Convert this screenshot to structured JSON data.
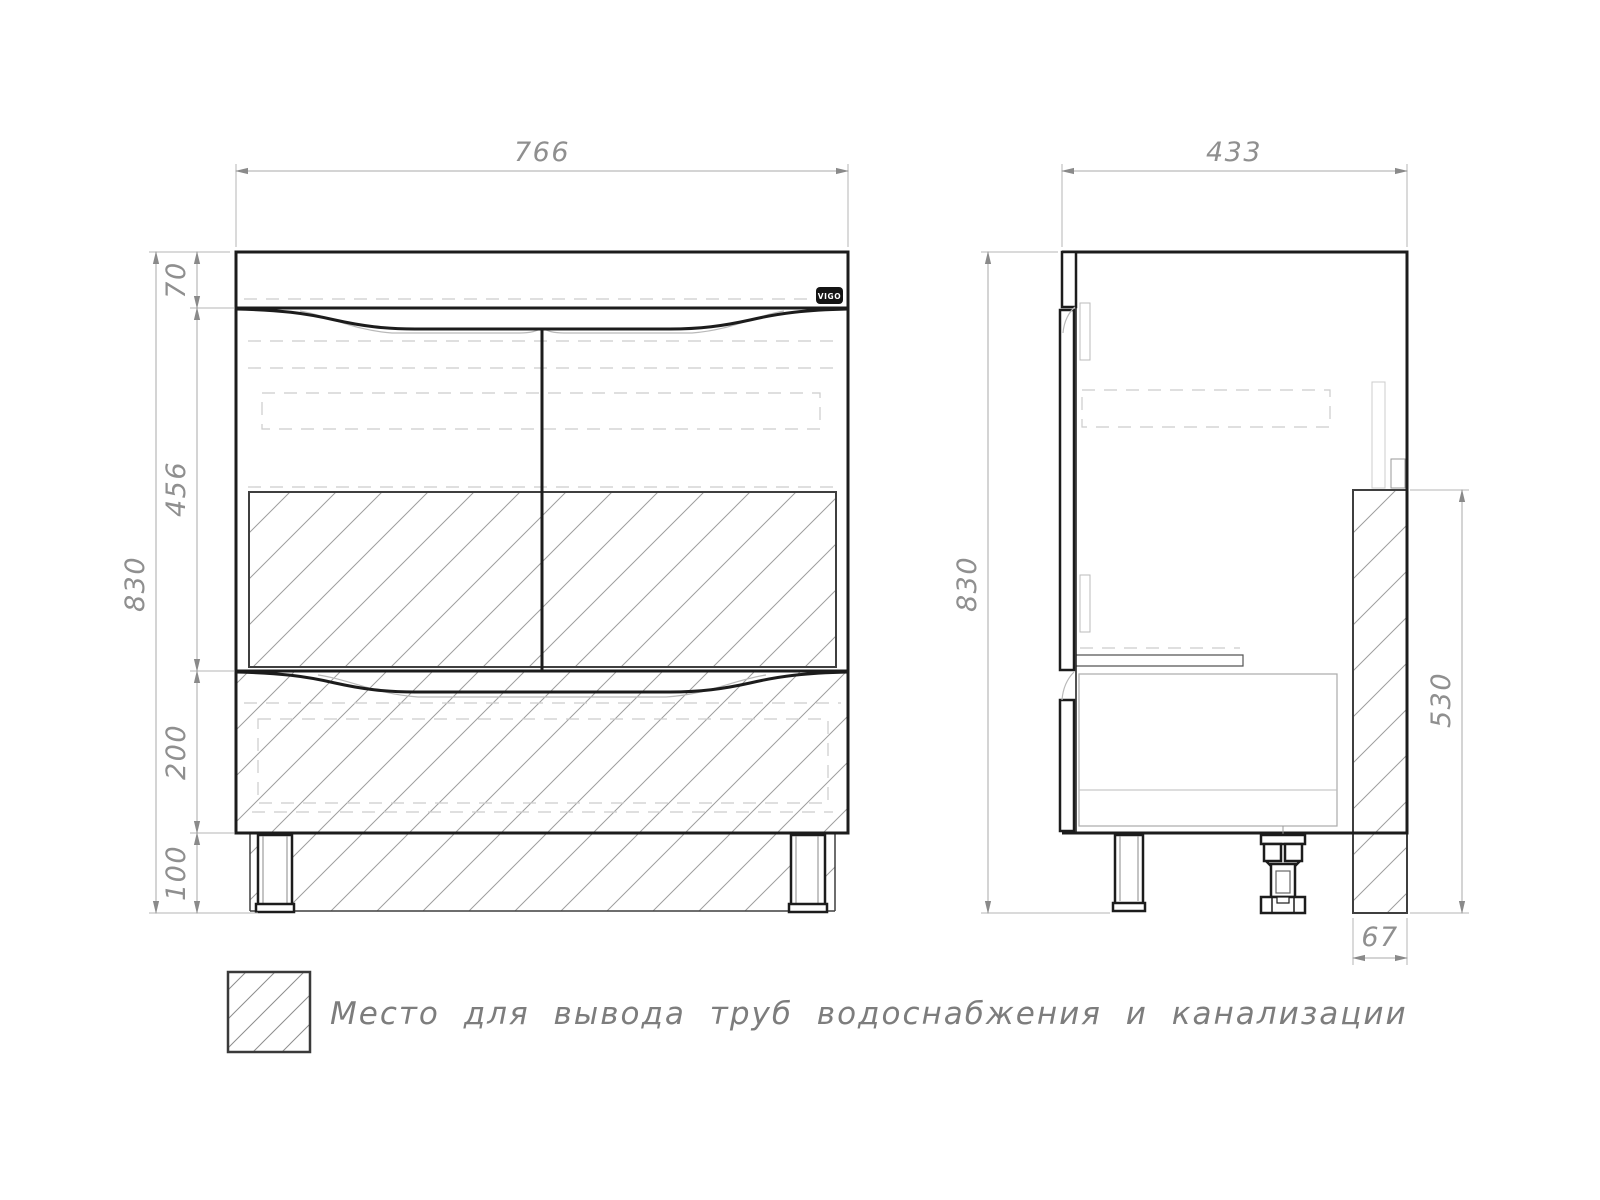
{
  "front_view": {
    "width": "766",
    "height": "830",
    "countertop": "70",
    "doors": "456",
    "drawer": "200",
    "legs": "100"
  },
  "side_view": {
    "depth": "433",
    "height": "830",
    "pipe_zone_height": "530",
    "pipe_zone_depth": "67"
  },
  "logo": {
    "text": "VIGO"
  },
  "legend": {
    "text": "Место для вывода труб водоснабжения и канализации"
  },
  "colors": {
    "outline": "#1c1c1c",
    "hatch": "#9e9e9e",
    "dimension": "#8f8f8f",
    "hidden_line": "#cccccc",
    "logo_bg": "#141414",
    "logo_text": "#ffffff",
    "background": "#ffffff"
  }
}
